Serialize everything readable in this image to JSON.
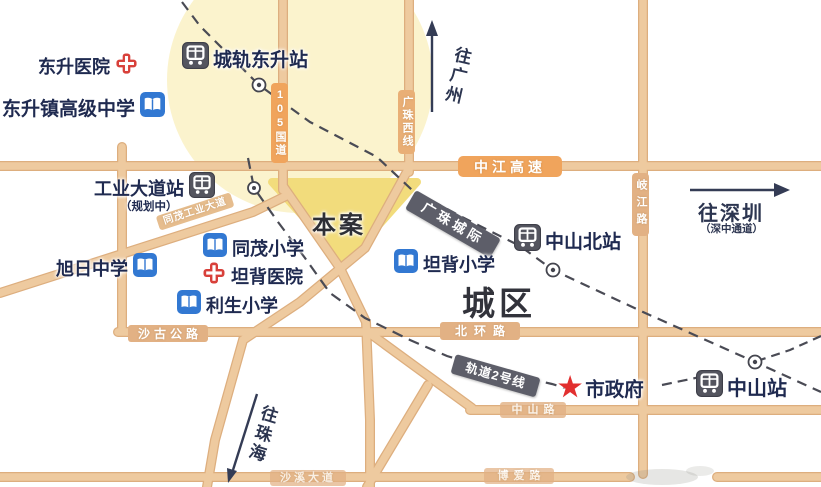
{
  "map": {
    "pois": {
      "dongsheng_hospital": "东升医院",
      "chenggui_dongsheng_station": "城轨东升站",
      "dongsheng_highschool": "东升镇高级中学",
      "gongye_dadao_station": "工业大道站",
      "gongye_planning": "（规划中）",
      "ben_an": "本案",
      "tongmao_primary": "同茂小学",
      "tanbei_hospital": "坦背医院",
      "xuri_middle": "旭日中学",
      "lisheng_primary": "利生小学",
      "tanbei_primary": "坦背小学",
      "zhongshan_north_station": "中山北站",
      "chengqu": "城区",
      "shizhengfu": "市政府",
      "zhongshan_station": "中山站"
    },
    "roads": {
      "g105": "105国道",
      "guangzhu_west": "广珠西线",
      "zhongjiang_expwy": "中江高速",
      "tongmao_industrial": "同茂工业大道",
      "qijiang": "岐江路",
      "beihuan": "北环路",
      "shagu": "沙古公路",
      "zhongshan_rd": "中山路",
      "boai": "博爱路",
      "shaxi": "沙溪大道"
    },
    "rails": {
      "guangzhu_intercity": "广珠城际",
      "line2": "轨道2号线"
    },
    "directions": {
      "to_guangzhou": "往广州",
      "to_shenzhen": "往深圳",
      "shenzhong_corridor": "（深中通道）",
      "to_zhuhai": "往珠海"
    },
    "icons": {
      "station": "train-station-icon",
      "school": "school-book-icon",
      "hospital": "red-cross-icon",
      "government": "red-star-icon",
      "rail_stop": "rail-stop-circle-icon"
    },
    "colors": {
      "road": "#eeca9f",
      "road_edge": "#ddae7e",
      "highway_badge": "#f0a45c",
      "road_badge": "#e2b184",
      "rail_badge": "#5d5e69",
      "school_icon": "#3278d2",
      "hospital_icon": "#d8403a",
      "station_icon": "#54555f",
      "label_text": "#1f2a50",
      "site_fill": "#f2dc7c",
      "glow_fill": "#fbf3cd",
      "star": "#e22f2f",
      "rail_line": "#4a4b55"
    }
  }
}
